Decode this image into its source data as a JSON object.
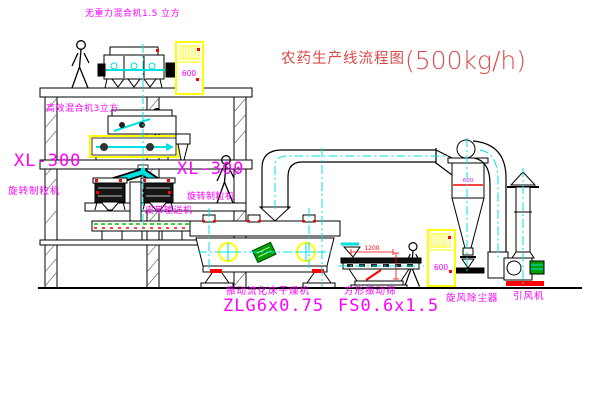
{
  "title": {
    "text": "农药生产线流程图",
    "capacity": "(500kg/h)"
  },
  "labels": {
    "gravity_mixer": "无重力混合机1.5 立方",
    "high_mixer": "高效混合机3立方",
    "granulator_model": "XL-300",
    "granulator_name": "旋转制粒机",
    "granulator_model_2": "XL-300",
    "granulator_name_2": "旋转制粒机",
    "belt_conveyor": "皮带输送机",
    "dryer_name": "振动流化床干燥机",
    "dryer_model": "ZLG6x0.75",
    "sieve_name": "方形振动筛",
    "sieve_model": "FS0.6x1.5",
    "cyclone_name": "旋风除尘器",
    "fan_name": "引风机",
    "cabinet_badge": "600",
    "cabinet_badge_2": "600",
    "cyclone_badge": "600",
    "sieve_dim": "1200"
  },
  "colors": {
    "label": "#ff00ff",
    "title": "#d94b4b",
    "centerline": "#00e0e0",
    "cabinet_yellow": "#ffff00",
    "accent_red": "#ff0000",
    "motor_green": "#00a000",
    "line": "#000000"
  }
}
